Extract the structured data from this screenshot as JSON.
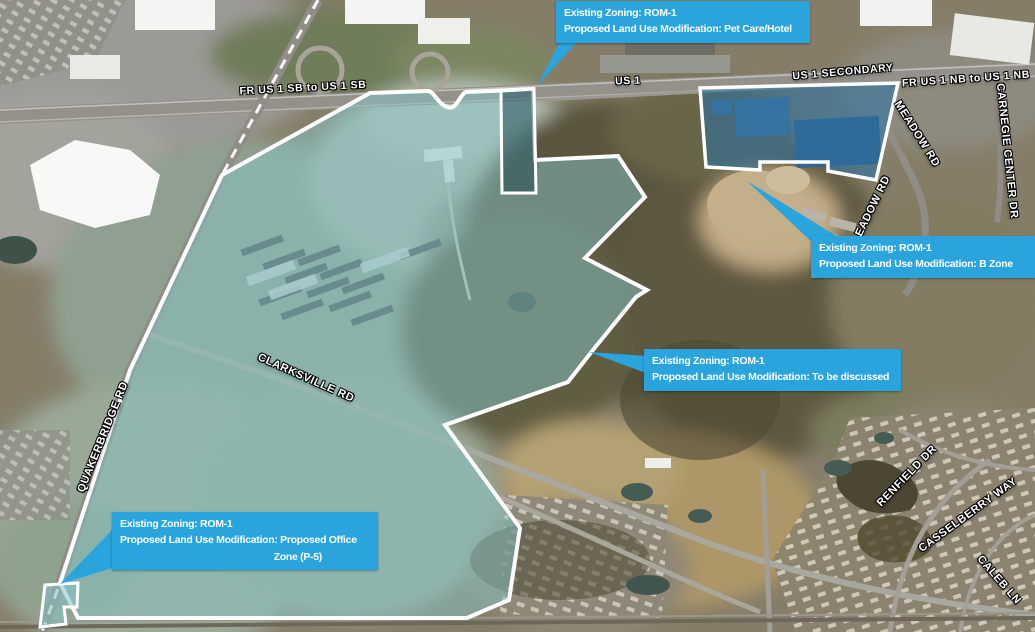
{
  "map": {
    "kind": "aerial zoning exhibit",
    "existing_zoning": "ROM-1"
  },
  "colors": {
    "callout_bg": "#29A4DC",
    "callout_text": "#ffffff",
    "parcel_outline": "#ffffff",
    "parcel_fill_teal": "rgba(133,195,198,0.5)",
    "parcel_fill_blue": "rgba(40,115,165,0.55)",
    "road_label_text": "#ffffff"
  },
  "callouts": [
    {
      "id": "pet-care-hotel",
      "line1": "Existing Zoning: ROM-1",
      "line2": "Proposed Land Use Modification: Pet Care/Hotel"
    },
    {
      "id": "b-zone",
      "line1": "Existing Zoning: ROM-1",
      "line2": "Proposed Land Use Modification: B Zone"
    },
    {
      "id": "to-be-discussed",
      "line1": "Existing Zoning: ROM-1",
      "line2": "Proposed Land Use Modification: To be discussed"
    },
    {
      "id": "proposed-office-zone",
      "line1": "Existing Zoning: ROM-1",
      "line2": "Proposed Land Use Modification: Proposed Office",
      "line3": "Zone (P-5)"
    }
  ],
  "road_labels": [
    {
      "text": "FR US 1 SB to US 1 SB"
    },
    {
      "text": "US 1"
    },
    {
      "text": "US 1 SECONDARY"
    },
    {
      "text": "FR US 1 NB to US 1 NB"
    },
    {
      "text": "MEADOW RD"
    },
    {
      "text": "EADOW RD"
    },
    {
      "text": "CARNEGIE CENTER DR"
    },
    {
      "text": "QUAKERBRIDGE RD"
    },
    {
      "text": "CLARKSVILLE RD"
    },
    {
      "text": "RENFIELD DR"
    },
    {
      "text": "CASSELBERRY WAY"
    },
    {
      "text": "CALEB LN"
    }
  ]
}
